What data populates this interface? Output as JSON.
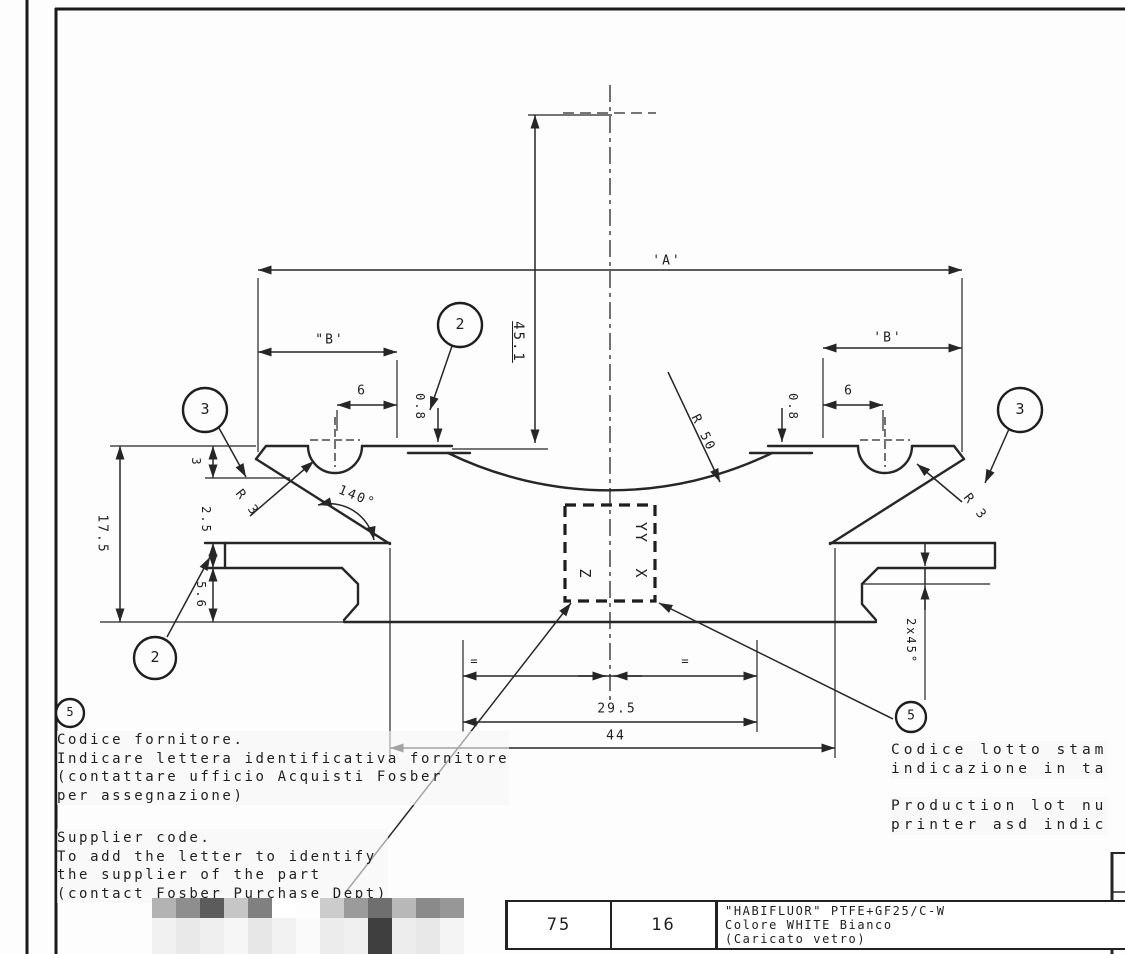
{
  "dims": {
    "a": "'A'",
    "b_left": "\"B'",
    "b_right": "'B'",
    "v45": "45.1",
    "six": "6",
    "o8": "0.8",
    "r50": "R 50",
    "deg140": "140°",
    "r3": "R 3",
    "v175": "17.5",
    "v3": "3",
    "v25": "2.5",
    "v56": "5.6",
    "cham": "2x45°",
    "eq": "=",
    "w295": "29.5",
    "w44": "44"
  },
  "balloons": {
    "two": "2",
    "three": "3",
    "five": "5"
  },
  "box": {
    "yy": "YY",
    "z": "Z",
    "x": "X"
  },
  "notes_left": {
    "it": [
      "Codice fornitore.",
      "Indicare lettera identificativa fornitore",
      "(contattare ufficio Acquisti Fosber",
      "per assegnazione)"
    ],
    "en": [
      "Supplier code.",
      "To add the letter to identify",
      "the supplier of the part",
      "(contact Fosber Purchase Dept)"
    ]
  },
  "notes_right": {
    "it": [
      "Codice lotto stam",
      "indicazione in ta"
    ],
    "en": [
      "Production lot nu",
      "printer asd indic"
    ]
  },
  "table": {
    "c1": "75",
    "c2": "16",
    "material": [
      "\"HABIFLUOR\" PTFE+GF25/C-W",
      "Colore WHITE Bianco",
      "(Caricato vetro)"
    ]
  },
  "censored": {
    "x": 152,
    "y": 898,
    "size": 24,
    "rows": [
      {
        "h": 20,
        "colors": [
          "#b3b3b3",
          "#8e8e8e",
          "#5c5c5c",
          "#c6c6c6",
          "#808080",
          "#ffffff",
          "#fdfdfd",
          "#cccccc",
          "#9b9b9b",
          "#6f6f6f",
          "#b8b8b8",
          "#8a8a8a",
          "#979797"
        ]
      },
      {
        "h": 36,
        "colors": [
          "#f1f1f1",
          "#e9e9e9",
          "#efefef",
          "#f6f6f6",
          "#e7e7e7",
          "#f2f2f2",
          "#fafafa",
          "#ececec",
          "#f0f0f0",
          "#3f3f3f",
          "#ededed",
          "#e8e8e8",
          "#f4f4f4"
        ]
      }
    ]
  }
}
